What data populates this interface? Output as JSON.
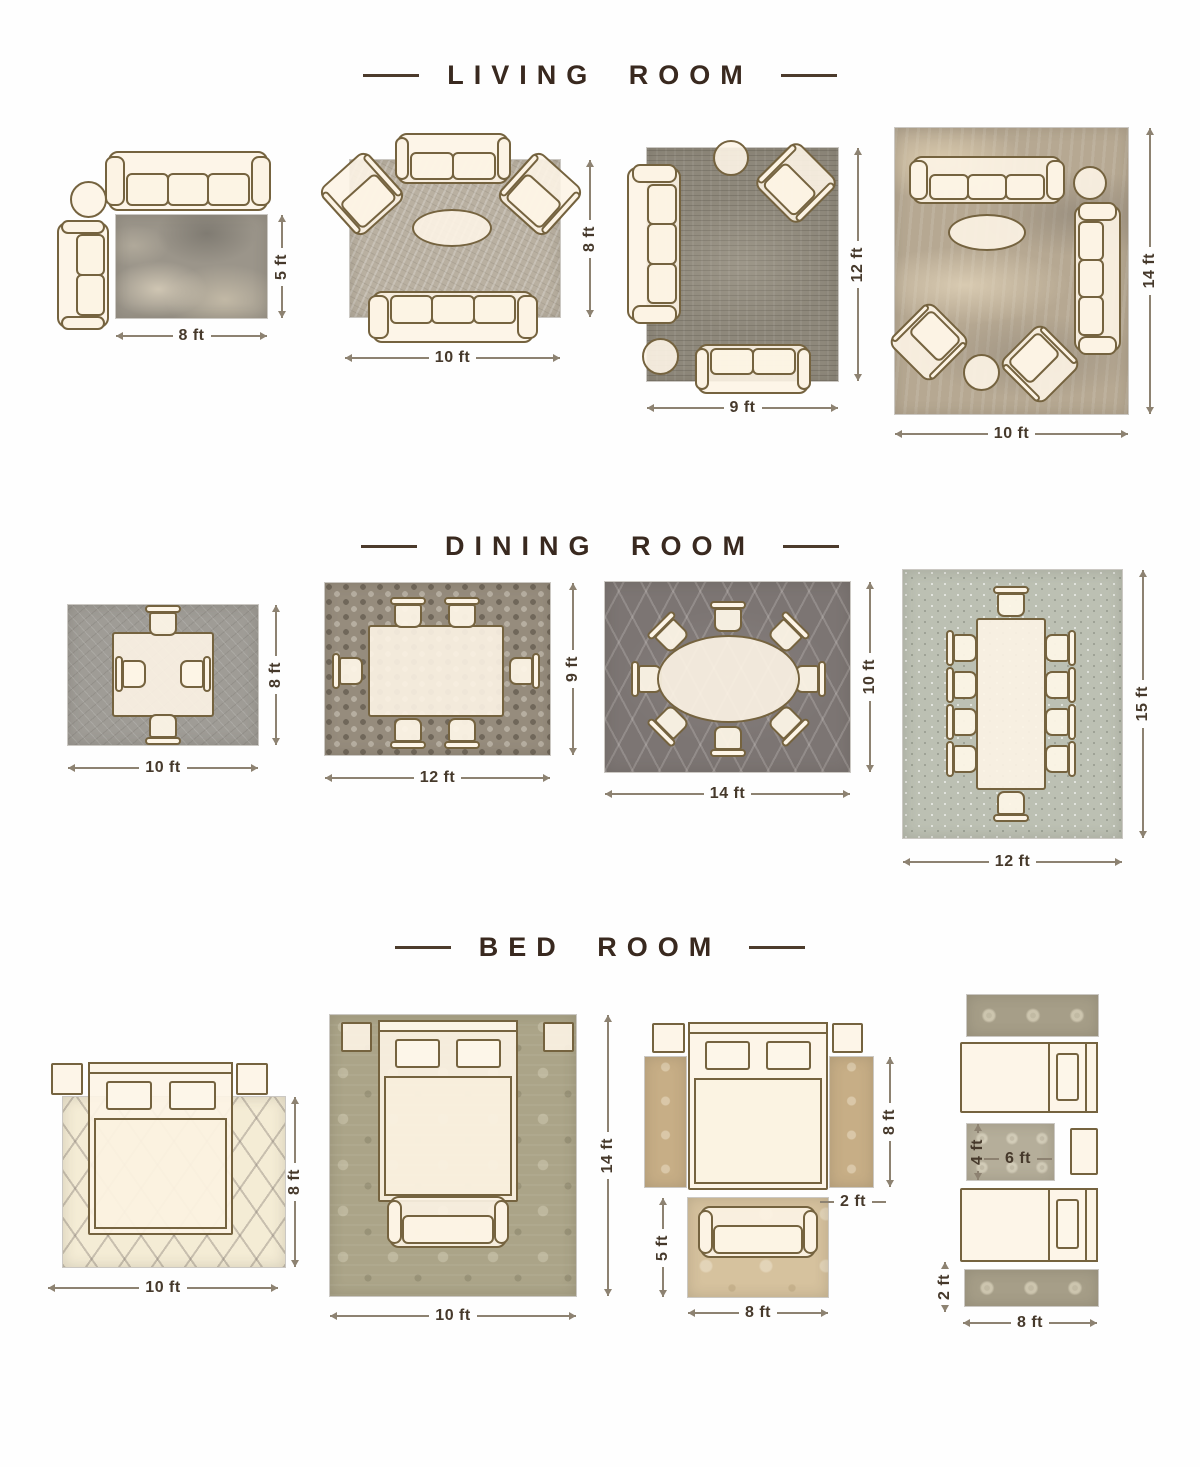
{
  "page_title": "Rug Size Guide",
  "colors": {
    "background": "#fefefe",
    "title_text": "#39291f",
    "title_dash": "#4c3b2c",
    "dimension_text": "#46392b",
    "dimension_line": "#8d8271",
    "furniture_fill": "#fcf3e4",
    "furniture_outline": "#75633f"
  },
  "sections": [
    {
      "title": "LIVING ROOM",
      "layouts": [
        {
          "width": "8 ft",
          "height": "5 ft"
        },
        {
          "width": "10 ft",
          "height": "8 ft"
        },
        {
          "width": "9 ft",
          "height": "12 ft"
        },
        {
          "width": "10 ft",
          "height": "14 ft"
        }
      ]
    },
    {
      "title": "DINING ROOM",
      "layouts": [
        {
          "width": "10 ft",
          "height": "8 ft"
        },
        {
          "width": "12 ft",
          "height": "9 ft"
        },
        {
          "width": "14 ft",
          "height": "10 ft"
        },
        {
          "width": "12 ft",
          "height": "15 ft"
        }
      ]
    },
    {
      "title": "BED ROOM",
      "layouts": [
        {
          "width": "10 ft",
          "height": "8 ft"
        },
        {
          "width": "10 ft",
          "height": "14 ft"
        },
        {
          "runner_height": "8 ft",
          "runner_width": "2 ft",
          "foot_rug_height": "5 ft",
          "foot_rug_width": "8 ft"
        },
        {
          "middle_rug_height": "4 ft",
          "middle_rug_width": "6 ft",
          "runner_width": "2 ft",
          "bed_width": "8 ft"
        }
      ]
    }
  ]
}
